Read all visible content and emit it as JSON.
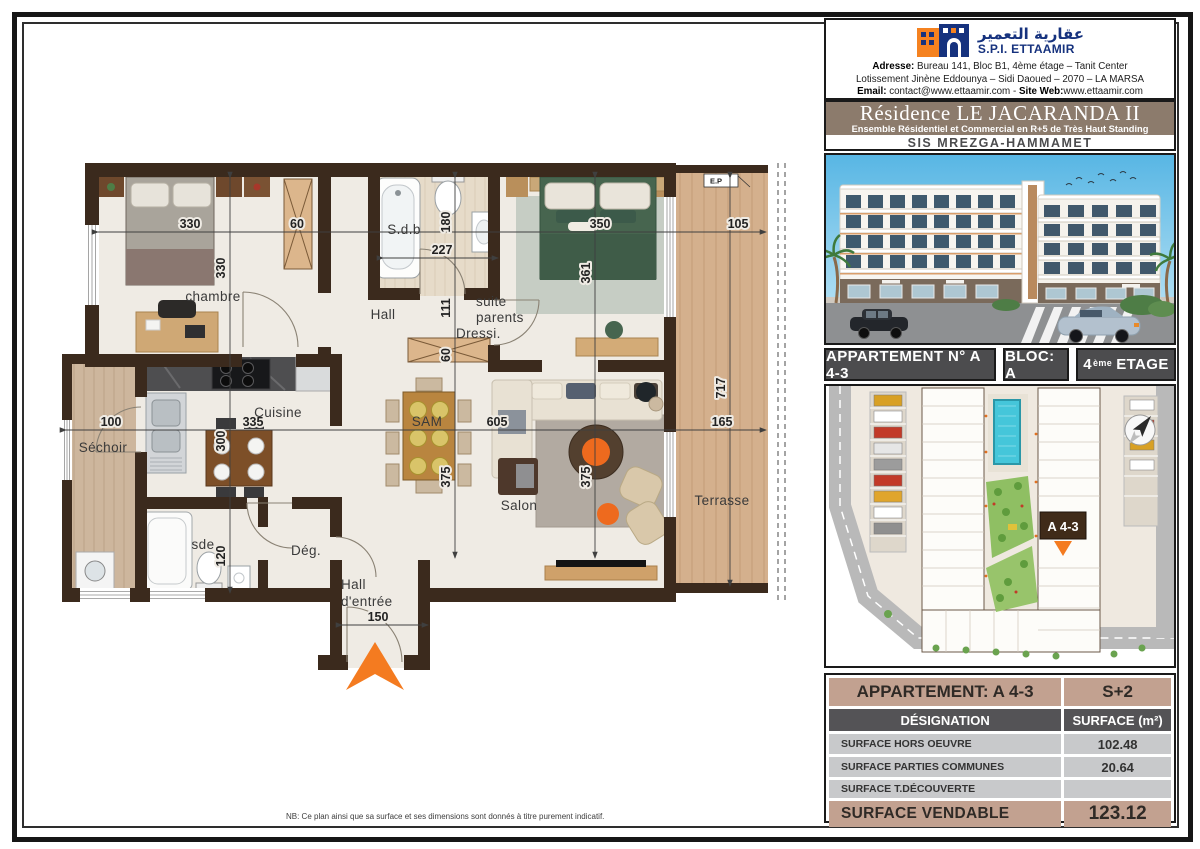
{
  "header": {
    "arabic_name": "عقارية التعمير",
    "company": "S.P.I. ETTAAMIR",
    "address_label": "Adresse:",
    "address": " Bureau 141, Bloc B1, 4ème étage – Tanit Center",
    "address2": "Lotissement Jinène Eddounya – Sidi Daoued – 2070 – LA MARSA",
    "email_label": "Email:",
    "email": " contact@www.ettaamir.com - ",
    "site_label": "Site Web:",
    "site": "www.ettaamir.com"
  },
  "title": {
    "main": "Résidence LE JACARANDA II",
    "subtitle": "Ensemble Résidentiel et Commercial en R+5 de Très Haut Standing",
    "location": "SIS MREZGA-HAMMAMET"
  },
  "apartment": {
    "label": "APPARTEMENT N° A 4-3",
    "bloc": "BLOC: A",
    "floor_num": "4",
    "floor_sup": "ème",
    "floor_word": "ETAGE"
  },
  "site_plan": {
    "marker": "A 4-3"
  },
  "surface_table": {
    "title_left": "APPARTEMENT: A 4-3",
    "title_right": "S+2",
    "col1": "DÉSIGNATION",
    "col2": "SURFACE (m²)",
    "rows": [
      {
        "label": "SURFACE HORS OEUVRE",
        "value": "102.48"
      },
      {
        "label": "SURFACE PARTIES COMMUNES",
        "value": "20.64"
      },
      {
        "label": "SURFACE T.DÉCOUVERTE",
        "value": ""
      }
    ],
    "total_label": "SURFACE VENDABLE",
    "total_value": "123.12"
  },
  "note": "NB: Ce plan ainsi que sa surface et ses dimensions sont donnés à titre purement indicatif.",
  "plan": {
    "rooms": {
      "chambre": "chambre",
      "sdb": "S.d.b",
      "hall": "Hall",
      "suite_1": "suite",
      "suite_2": "parents",
      "dressing": "Dressi.",
      "cuisine": "Cuisine",
      "sechoir": "Séchoir",
      "sde": "sde",
      "deg": "Dég.",
      "sam": "SAM",
      "salon": "Salon",
      "terrasse": "Terrasse",
      "entree_1": "Hall",
      "entree_2": "d'entrée",
      "ep": "E.P"
    },
    "dims": {
      "chambre_w": "330",
      "chambre_h": "330",
      "closet_w": "60",
      "sdb_w": "227",
      "sdb_h": "180",
      "suite_w": "350",
      "suite_h": "361",
      "terrace_top_w": "105",
      "terrace_h": "717",
      "terrace_w": "165",
      "sechoir_w": "100",
      "cuisine_w": "335",
      "cuisine_h": "300",
      "hall_h": "111",
      "dressing_d": "60",
      "living_w": "605",
      "sam_h": "375",
      "salon_h": "375",
      "sde_h": "120",
      "entry_w": "150"
    }
  },
  "colors": {
    "accent_orange": "#f47b20",
    "wall_brown": "#3b2a1d",
    "logo_blue": "#16327e",
    "logo_orange": "#f58220",
    "title_bg": "#8c7b6c",
    "table_tan": "#c2a190",
    "table_dark": "#545356",
    "table_gray": "#c8c9cb"
  }
}
